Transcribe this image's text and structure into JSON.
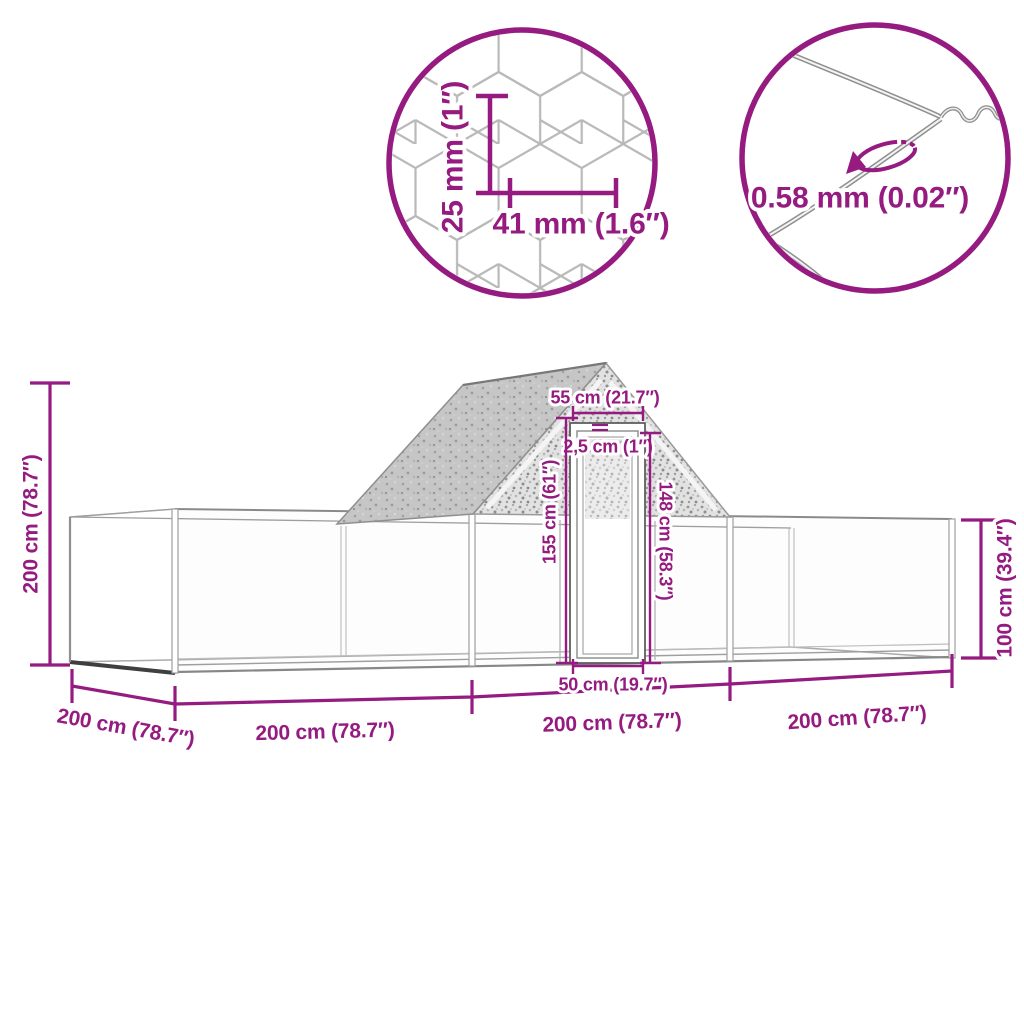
{
  "colors": {
    "dimension_purple": "#951b81",
    "frame_gray": "#9e9e9e",
    "mesh_gray": "#b9b9b9",
    "dark_edge": "#3f3f3f"
  },
  "mesh_inset": {
    "cell_height": "25 mm (1″)",
    "cell_width": "41 mm (1.6″)"
  },
  "wire_inset": {
    "wire_thickness": "0.58 mm (0.02″)"
  },
  "coop": {
    "total_height": "200 cm (78.7″)",
    "wall_height": "100 cm (39.4″)",
    "depth": "200 cm (78.7″)",
    "section_lengths": [
      "200 cm (78.7″)",
      "200 cm (78.7″)",
      "200 cm (78.7″)"
    ],
    "door": {
      "top_width": "55 cm (21.7″)",
      "frame_thickness": "2,5 cm (1″)",
      "outer_height": "155 cm (61″)",
      "inner_height": "148 cm (58.3″)",
      "bottom_width": "50 cm (19.7″)"
    }
  }
}
